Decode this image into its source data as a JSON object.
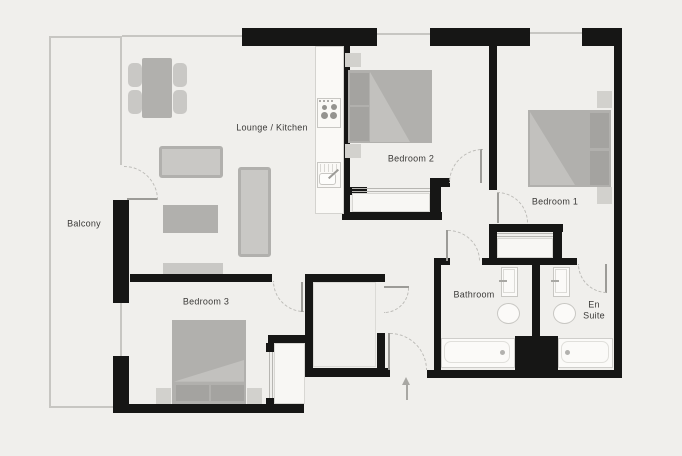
{
  "title": "Floor plan",
  "rooms": {
    "balcony": {
      "label": "Balcony"
    },
    "lounge_kitchen": {
      "label": "Lounge / Kitchen"
    },
    "bedroom_1": {
      "label": "Bedroom 1"
    },
    "bedroom_2": {
      "label": "Bedroom 2"
    },
    "bedroom_3": {
      "label": "Bedroom 3"
    },
    "bathroom": {
      "label": "Bathroom"
    },
    "en_suite": {
      "label": "En Suite"
    }
  },
  "colors": {
    "wall": "#161615",
    "background": "#f0efec",
    "furniture": "#b1b0ad",
    "furniture_light": "#c9c8c5",
    "pillow": "#a4a3a0",
    "fixture_outline": "#c8c7c3",
    "door_swing_dash": "#bcbbb7",
    "text": "#3b3a38"
  },
  "icons": {
    "entrance_arrow": "entry-direction-arrow",
    "hob": "4-ring-hob",
    "sink": "kitchen-sink"
  }
}
